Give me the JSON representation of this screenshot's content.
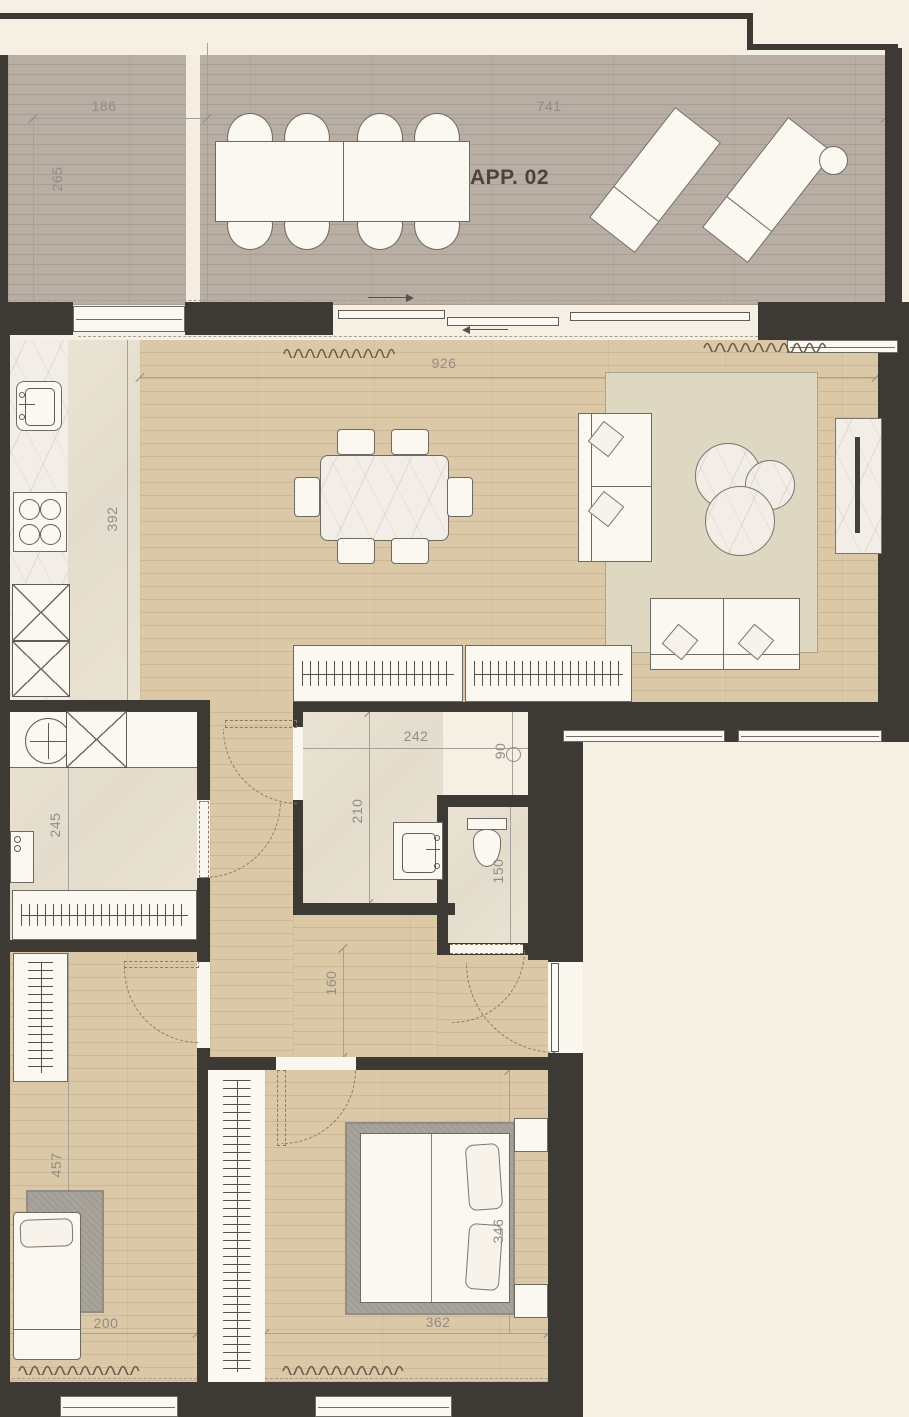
{
  "title": "APP. 02",
  "dims": {
    "terrace_section_width": "186",
    "terrace_depth": "265",
    "terrace_width": "741",
    "living_width": "926",
    "kitchen_run": "392",
    "utility_depth": "245",
    "bath_width": "242",
    "bath_depth": "210",
    "shaft_width": "90",
    "wc_depth": "150",
    "hall_width": "160",
    "bedroom1_depth": "457",
    "bedroom1_width": "200",
    "bedroom2_width": "362",
    "bedroom2_depth": "346"
  },
  "colors": {
    "wall": "#3d3a35",
    "deck": "#b3a99e",
    "wood": "#d8c5a3",
    "tile": "#e8e1d2",
    "dim_text": "#918c85",
    "title_text": "#4b443c"
  }
}
